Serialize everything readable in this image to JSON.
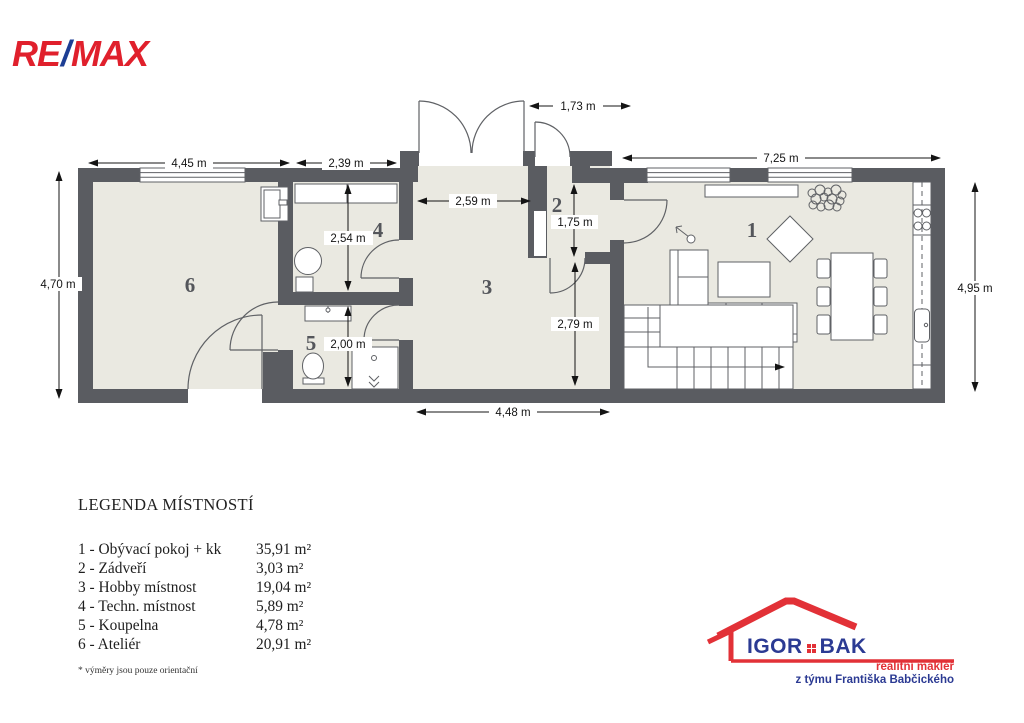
{
  "brand": {
    "re": "RE",
    "slash": "/",
    "max": "MAX"
  },
  "floor_plan": {
    "room_labels": [
      {
        "number": "1"
      },
      {
        "number": "2"
      },
      {
        "number": "3"
      },
      {
        "number": "4"
      },
      {
        "number": "5"
      },
      {
        "number": "6"
      }
    ],
    "dimensions": [
      {
        "name": "top-left-width",
        "label": "4,45 m"
      },
      {
        "name": "top-mid-width",
        "label": "2,39 m"
      },
      {
        "name": "entry-door-width",
        "label": "1,73 m"
      },
      {
        "name": "top-right-width",
        "label": "7,25 m"
      },
      {
        "name": "left-height",
        "label": "4,70 m"
      },
      {
        "name": "right-height",
        "label": "4,95 m"
      },
      {
        "name": "room3-top-width",
        "label": "2,59 m"
      },
      {
        "name": "room2-height",
        "label": "1,75 m"
      },
      {
        "name": "room3-right-height",
        "label": "2,79 m"
      },
      {
        "name": "room4-height",
        "label": "2,54 m"
      },
      {
        "name": "room5-height",
        "label": "2,00 m"
      },
      {
        "name": "bottom-width",
        "label": "4,48 m"
      }
    ],
    "fixtures": [
      "staircase",
      "l-shaped-sofa",
      "coffee-table",
      "rug",
      "dining-table",
      "dining-chairs",
      "sideboard",
      "plant",
      "floor-lamp",
      "kitchen-counter",
      "stove",
      "kitchen-sink",
      "washbasin",
      "toilet",
      "shower",
      "boiler",
      "cabinet",
      "windows",
      "doors"
    ]
  },
  "legend": {
    "title": "LEGENDA MÍSTNOSTÍ",
    "items": [
      {
        "name": "1 - Obývací pokoj + kk",
        "area": "35,91 m²"
      },
      {
        "name": "2 - Zádveří",
        "area": "3,03 m²"
      },
      {
        "name": "3 - Hobby místnost",
        "area": "19,04 m²"
      },
      {
        "name": "4 - Techn. místnost",
        "area": "5,89 m²"
      },
      {
        "name": "5 - Koupelna",
        "area": "4,78 m²"
      },
      {
        "name": "6 - Ateliér",
        "area": "20,91 m²"
      }
    ],
    "footnote": "* výměry jsou pouze orientační"
  },
  "agent": {
    "first_name": "IGOR",
    "last_name": "BAK",
    "tagline1": "realitní makléř",
    "tagline2": "z týmu Františka Babčického"
  },
  "colors": {
    "wall": "#5a5c61",
    "floor": "#eae9e1",
    "remax_red": "#e0202c",
    "remax_blue": "#1d3e94",
    "agent_red": "#e23137",
    "agent_blue": "#2b3a93"
  }
}
